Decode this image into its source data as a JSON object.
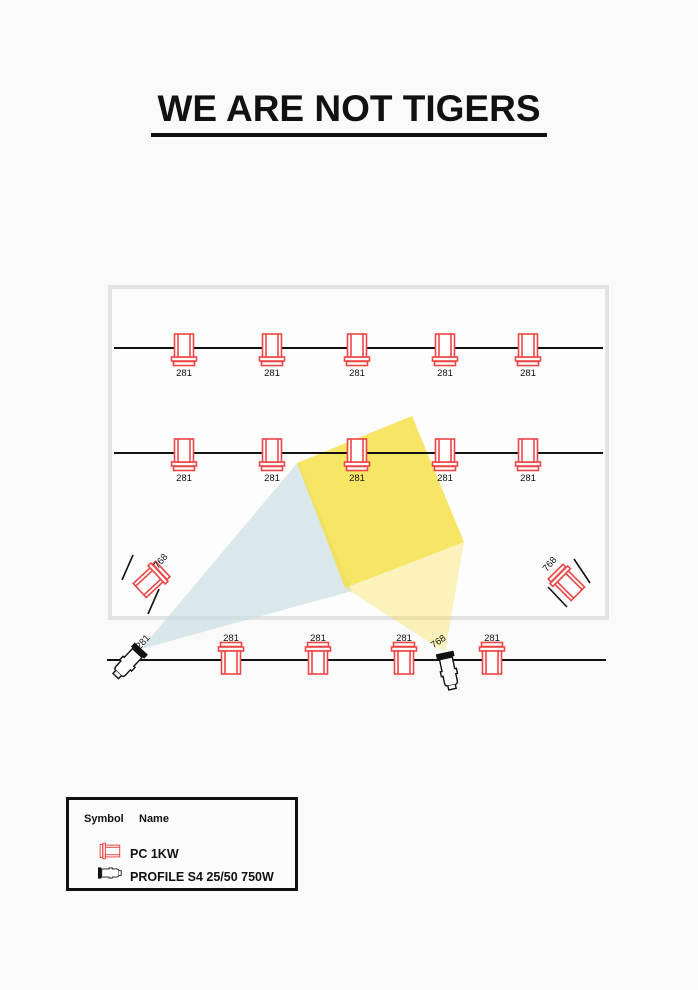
{
  "title": "WE ARE NOT TIGERS",
  "legend": {
    "symbol_header": "Symbol",
    "name_header": "Name",
    "rows": [
      {
        "symbol": "pc-symbol",
        "name": "PC 1KW"
      },
      {
        "symbol": "profile-symbol",
        "name": "PROFILE S4 25/50 750W"
      }
    ]
  },
  "colors": {
    "fixture_red": "#ee4545",
    "profile_black": "#111111",
    "pipe_black": "#111111",
    "stage_fill": "#fdfdfd",
    "stage_border": "#e3e3e3",
    "beam_blue": "#c7dde4",
    "beam_yellow": "#f5df3f",
    "label_text": "#111111"
  },
  "plot": {
    "stage": {
      "x": 110,
      "y": 287,
      "w": 497,
      "h": 331
    },
    "pipes": [
      {
        "name": "electric-1",
        "x1": 114,
        "y1": 348,
        "x2": 603,
        "y2": 348
      },
      {
        "name": "electric-2",
        "x1": 114,
        "y1": 453,
        "x2": 603,
        "y2": 453
      },
      {
        "name": "foh-pipe",
        "x1": 107,
        "y1": 660,
        "x2": 606,
        "y2": 660
      }
    ],
    "beams": [
      {
        "name": "beam-blue",
        "color": "#c7dde4",
        "opacity": 0.65,
        "points": [
          [
            141,
            649
          ],
          [
            298,
            462
          ],
          [
            352,
            591
          ]
        ]
      },
      {
        "name": "beam-yellow-pale",
        "color": "#f5df3f",
        "opacity": 0.35,
        "points": [
          [
            345,
            588
          ],
          [
            445,
            652
          ],
          [
            464,
            542
          ]
        ]
      },
      {
        "name": "beam-yellow-bright",
        "color": "#f5df3f",
        "opacity": 0.8,
        "points": [
          [
            412,
            416
          ],
          [
            297,
            463
          ],
          [
            345,
            588
          ],
          [
            464,
            542
          ]
        ]
      }
    ],
    "boom_ticks": [
      {
        "name": "left-boom-tick-1",
        "x1": 133,
        "y1": 555,
        "x2": 122,
        "y2": 580
      },
      {
        "name": "left-boom-tick-2",
        "x1": 159,
        "y1": 589,
        "x2": 148,
        "y2": 614
      },
      {
        "name": "right-boom-tick-1",
        "x1": 574,
        "y1": 559,
        "x2": 590,
        "y2": 583
      },
      {
        "name": "right-boom-tick-2",
        "x1": 548,
        "y1": 587,
        "x2": 567,
        "y2": 607
      }
    ],
    "fixtures": [
      {
        "type": "pc",
        "x": 184,
        "y": 348,
        "rot": 180,
        "label": "281",
        "lx": 184,
        "ly": 376,
        "lrot": 0
      },
      {
        "type": "pc",
        "x": 272,
        "y": 348,
        "rot": 180,
        "label": "281",
        "lx": 272,
        "ly": 376,
        "lrot": 0
      },
      {
        "type": "pc",
        "x": 357,
        "y": 348,
        "rot": 180,
        "label": "281",
        "lx": 357,
        "ly": 376,
        "lrot": 0
      },
      {
        "type": "pc",
        "x": 445,
        "y": 348,
        "rot": 180,
        "label": "281",
        "lx": 445,
        "ly": 376,
        "lrot": 0
      },
      {
        "type": "pc",
        "x": 528,
        "y": 348,
        "rot": 180,
        "label": "281",
        "lx": 528,
        "ly": 376,
        "lrot": 0
      },
      {
        "type": "pc",
        "x": 184,
        "y": 453,
        "rot": 180,
        "label": "281",
        "lx": 184,
        "ly": 481,
        "lrot": 0
      },
      {
        "type": "pc",
        "x": 272,
        "y": 453,
        "rot": 180,
        "label": "281",
        "lx": 272,
        "ly": 481,
        "lrot": 0
      },
      {
        "type": "pc",
        "x": 357,
        "y": 453,
        "rot": 180,
        "label": "281",
        "lx": 357,
        "ly": 481,
        "lrot": 0
      },
      {
        "type": "pc",
        "x": 445,
        "y": 453,
        "rot": 180,
        "label": "281",
        "lx": 445,
        "ly": 481,
        "lrot": 0
      },
      {
        "type": "pc",
        "x": 528,
        "y": 453,
        "rot": 180,
        "label": "281",
        "lx": 528,
        "ly": 481,
        "lrot": 0
      },
      {
        "type": "pc",
        "x": 150,
        "y": 581,
        "rot": 47,
        "label": "768",
        "lx": 163,
        "ly": 563,
        "lrot": -50
      },
      {
        "type": "pc",
        "x": 568,
        "y": 584,
        "rot": -45,
        "label": "768",
        "lx": 552,
        "ly": 566,
        "lrot": -50
      },
      {
        "type": "pc",
        "x": 231,
        "y": 660,
        "rot": 0,
        "label": "281",
        "lx": 231,
        "ly": 641,
        "lrot": 0
      },
      {
        "type": "pc",
        "x": 318,
        "y": 660,
        "rot": 0,
        "label": "281",
        "lx": 318,
        "ly": 641,
        "lrot": 0
      },
      {
        "type": "pc",
        "x": 404,
        "y": 660,
        "rot": 0,
        "label": "281",
        "lx": 404,
        "ly": 641,
        "lrot": 0
      },
      {
        "type": "pc",
        "x": 492,
        "y": 660,
        "rot": 0,
        "label": "281",
        "lx": 492,
        "ly": 641,
        "lrot": 0
      },
      {
        "type": "profile",
        "x": 127,
        "y": 664,
        "rot": 43,
        "label": "281",
        "lx": 145,
        "ly": 644,
        "lrot": -48
      },
      {
        "type": "profile",
        "x": 449,
        "y": 673,
        "rot": -12,
        "label": "768",
        "lx": 440,
        "ly": 644,
        "lrot": -35
      }
    ]
  }
}
